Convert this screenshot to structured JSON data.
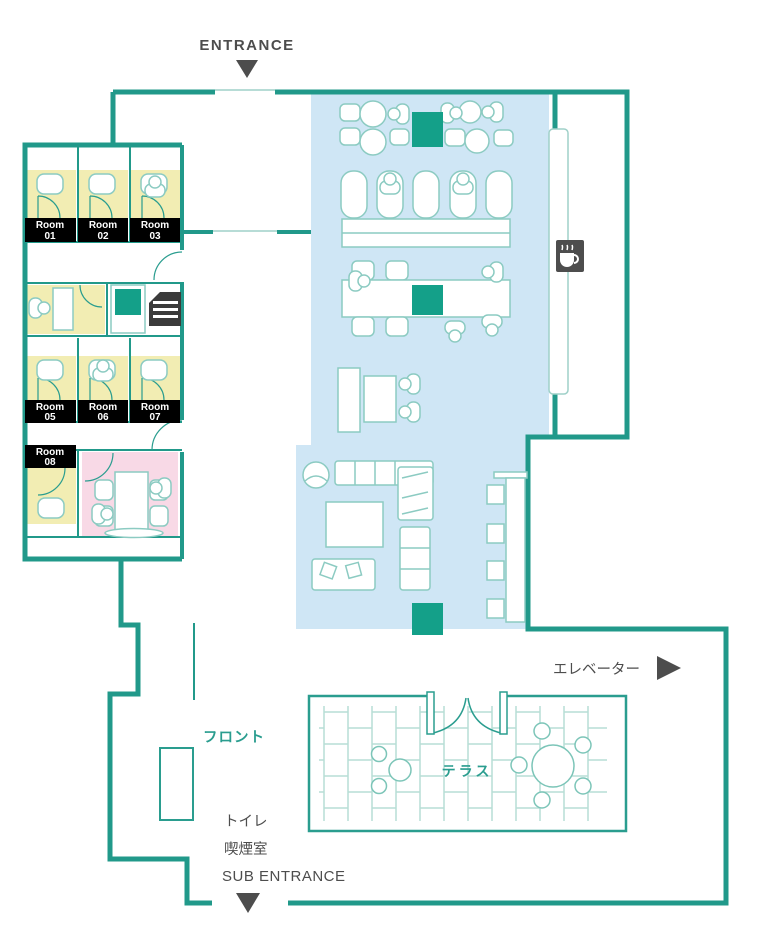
{
  "labels": {
    "entrance": "ENTRANCE",
    "sub_entrance": "SUB ENTRANCE",
    "elevator": "エレベーター",
    "front_desk": "フロント",
    "toilet": "トイレ",
    "smoking_room": "喫煙室",
    "terrace": "テラス"
  },
  "rooms": [
    {
      "line1": "Room",
      "line2": "01"
    },
    {
      "line1": "Room",
      "line2": "02"
    },
    {
      "line1": "Room",
      "line2": "03"
    },
    {
      "line1": "Room",
      "line2": "05"
    },
    {
      "line1": "Room",
      "line2": "06"
    },
    {
      "line1": "Room",
      "line2": "07"
    },
    {
      "line1": "Room",
      "line2": "08"
    }
  ],
  "colors": {
    "wall_teal": "#21998a",
    "furniture_outline": "#8ccbc2",
    "zone_blue": "#cfe6f5",
    "zone_yellow": "#f2edb3",
    "zone_pink": "#f8d9e6",
    "accent_green": "#14a089",
    "text_gray": "#4d4d4d",
    "text_teal": "#2a9d8f",
    "room_label_bg": "#000000",
    "room_label_text": "#ffffff"
  },
  "icons": {
    "coffee": "coffee-machine-icon",
    "printer": "printer-copier-icon",
    "entrance_arrow": "down-arrow-icon",
    "sub_entrance_arrow": "down-arrow-icon",
    "elevator_arrow": "right-arrow-icon"
  }
}
